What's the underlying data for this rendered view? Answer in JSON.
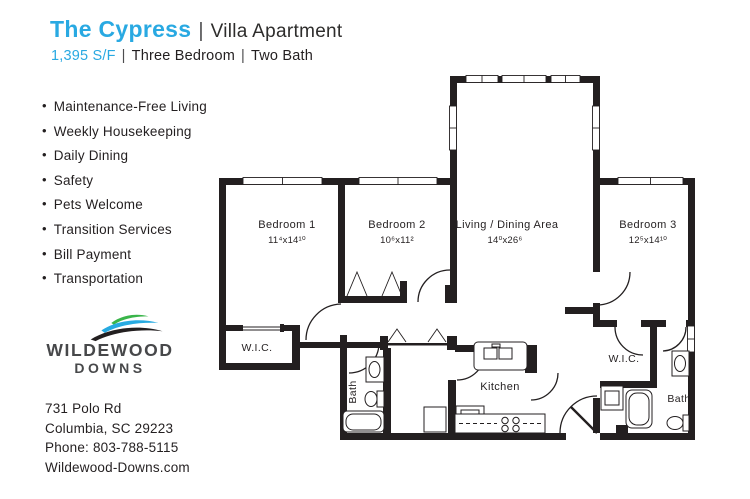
{
  "header": {
    "title": "The Cypress",
    "divider": "|",
    "subtitle": "Villa Apartment",
    "area": "1,395 S/F",
    "spec_bedrooms": "Three Bedroom",
    "spec_baths": "Two Bath"
  },
  "amenities": [
    "Maintenance-Free Living",
    "Weekly Housekeeping",
    "Daily Dining",
    "Safety",
    "Pets Welcome",
    "Transition Services",
    "Bill Payment",
    "Transportation"
  ],
  "logo": {
    "name_top": "WILDEWOOD",
    "name_bottom": "DOWNS"
  },
  "contact": {
    "address_line1": "731 Polo Rd",
    "address_line2": "Columbia, SC 29223",
    "phone": "Phone: 803-788-5115",
    "website": "Wildewood-Downs.com"
  },
  "floorplan": {
    "bedroom1": {
      "label": "Bedroom 1",
      "dims": "11⁴x14¹⁰"
    },
    "bedroom2": {
      "label": "Bedroom 2",
      "dims": "10⁶x11²"
    },
    "living": {
      "label": "Living / Dining  Area",
      "dims": "14⁰x26⁶"
    },
    "bedroom3": {
      "label": "Bedroom 3",
      "dims": "12⁵x14¹⁰"
    },
    "wic_left": {
      "label": "W.I.C."
    },
    "wic_right": {
      "label": "W.I.C."
    },
    "bath_left": {
      "label": "Bath"
    },
    "bath_right": {
      "label": "Bath"
    },
    "kitchen": {
      "label": "Kitchen"
    }
  },
  "colors": {
    "accent_blue": "#29a9e2",
    "ink": "#231f20",
    "logo_green": "#3ab54a",
    "logo_blue": "#27aae1",
    "logo_gray": "#47484a"
  }
}
